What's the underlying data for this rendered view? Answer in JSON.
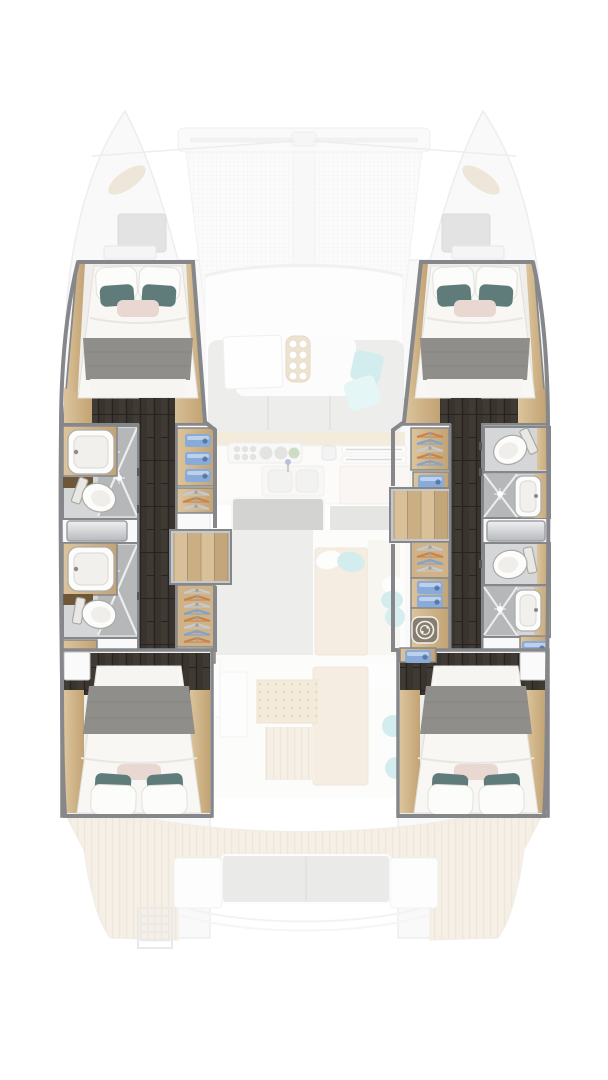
{
  "plan": {
    "label": "Catamaran yacht interior floor plan, overhead view",
    "note": "4-cabin 4-bathroom layout; hull accommodations rendered in full color, deck and saloon rendered faded"
  },
  "areas": {
    "foredeck": {
      "label": "Foredeck with bow hatches"
    },
    "trampoline": {
      "label": "Bow trampoline net"
    },
    "crossbeam": {
      "label": "Forward crossbeam"
    },
    "saloon": {
      "label": "Saloon with forward seating"
    },
    "galley": {
      "label": "Galley with stove, double sink and island"
    },
    "cockpit": {
      "label": "Cockpit with sun loungers and side bench"
    },
    "aft_deck": {
      "label": "Aft deck with bench seat and swim platforms"
    },
    "swim_ladder": {
      "label": "Boarding ladder"
    },
    "port_hull": {
      "label": "Port hull accommodation",
      "fore_cabin": {
        "label": "Port forward double cabin"
      },
      "fwd_bathroom": {
        "label": "Port forward bathroom with basin, shower and toilet"
      },
      "aft_bathroom": {
        "label": "Port aft bathroom with basin, shower and toilet"
      },
      "corridor": {
        "label": "Port hull companionway corridor"
      },
      "storage": {
        "label": "Port shelving with towels and hangers"
      },
      "stairs": {
        "label": "Port companionway steps"
      },
      "wardrobe": {
        "label": "Port hanging wardrobe"
      },
      "aft_cabin": {
        "label": "Port aft double cabin"
      }
    },
    "starboard_hull": {
      "label": "Starboard hull accommodation",
      "fore_cabin": {
        "label": "Starboard forward double cabin"
      },
      "fwd_bathroom": {
        "label": "Starboard forward bathroom with toilet, shower and basin"
      },
      "aft_bathroom": {
        "label": "Starboard aft bathroom with toilet, shower and basin"
      },
      "corridor": {
        "label": "Starboard hull companionway corridor"
      },
      "storage": {
        "label": "Starboard shelving with towels and hangers"
      },
      "stairs": {
        "label": "Starboard companionway steps"
      },
      "wardrobe": {
        "label": "Starboard hanging wardrobe"
      },
      "laundry": {
        "label": "Washer / dryer"
      },
      "aft_cabin": {
        "label": "Starboard aft double cabin"
      }
    }
  },
  "palette": {
    "wall": "#85878a",
    "wood_light": "#dcc49c",
    "wood_dark": "#c2a374",
    "wood_deep": "#6e5638",
    "floor_dark": "#39342e",
    "bed_white": "#f8f7f4",
    "blanket_gray": "#8f8e8a",
    "pillow_teal": "#5f7c7a",
    "pillow_pink": "#e9d7d2",
    "towel_blue": "#89abd9",
    "hanger_orange": "#c8824a",
    "hanger_blue": "#7fa3cc",
    "hanger_silver": "#c6cbd0",
    "shower_gray": "#b5b7b9",
    "bath_floor": "#d5d6d8",
    "fixture_white": "#fcfcfb",
    "deck_wood": "#ece1cd",
    "cushion_teal": "#a9dce0",
    "sofa_gray": "#d6d6d4",
    "shell": "#f4f4f6",
    "shell_line": "#dddde1"
  }
}
